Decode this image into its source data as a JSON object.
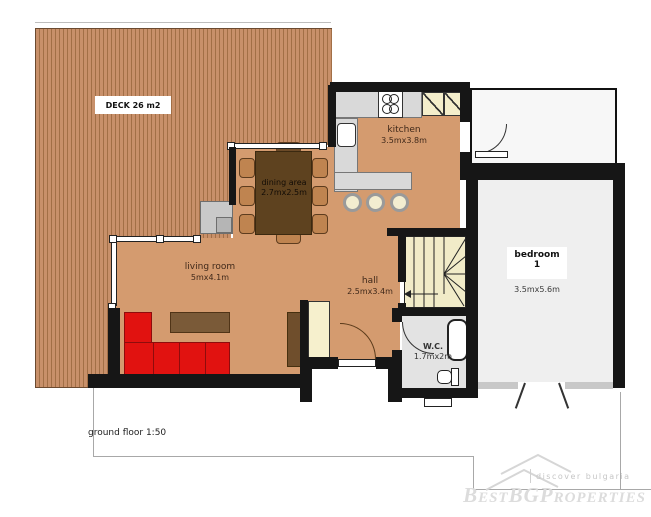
{
  "plan": {
    "scale_label": "ground floor 1:50",
    "deck": {
      "label": "DECK 26 m2"
    },
    "kitchen": {
      "name": "kitchen",
      "dims": "3.5mx3.8m"
    },
    "dining": {
      "name": "dining area",
      "dims": "2.7mx2.5m"
    },
    "living": {
      "name": "living room",
      "dims": "5mx4.1m"
    },
    "hall": {
      "name": "hall",
      "dims": "2.5mx3.4m"
    },
    "wc": {
      "name": "W.C.",
      "dims": "1.7mx2m"
    },
    "bedroom": {
      "name": "bedroom",
      "number": "1",
      "dims": "3.5mx5.6m"
    }
  },
  "watermark": {
    "tagline": "discover bulgaria",
    "brand": "BestBGProperties"
  },
  "colors": {
    "wall": "#161616",
    "floor_tan": "#d49b6f",
    "deck_light": "#c8906a",
    "deck_dark": "#a26f46",
    "sofa_red": "#e11210",
    "table_brown": "#5e421f",
    "chair_tan": "#bf8450",
    "counter_gray": "#d9d9d9",
    "cabinet_cream": "#f4eecb",
    "stairs_cream": "#f1ebc8",
    "wc_floor": "#e3e3e3",
    "bedroom_floor": "#efefef",
    "watermark_gray": "#dcdcdc"
  }
}
